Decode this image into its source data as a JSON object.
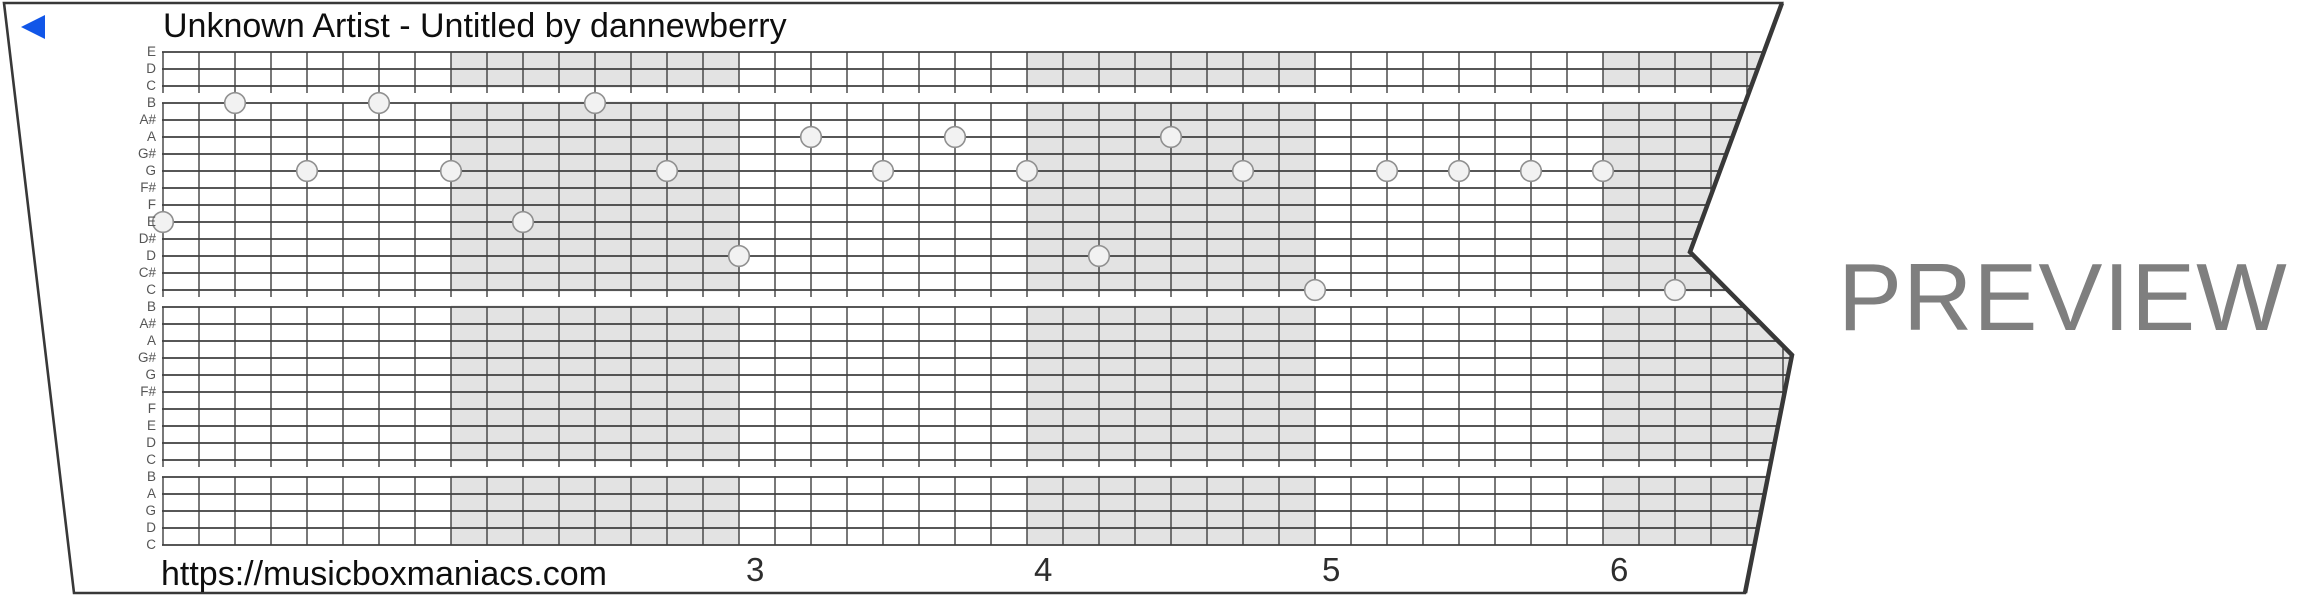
{
  "header": {
    "title": "Unknown Artist - Untitled by dannewberry"
  },
  "player": {
    "icon": "play-left-triangle"
  },
  "watermark": {
    "label": "PREVIEW"
  },
  "footer": {
    "url": "https://musicboxmaniacs.com"
  },
  "colors": {
    "accent_blue": "#1156e8",
    "measure_shade": "#e3e3e3",
    "grid_line": "#3f3f3f",
    "note_fill": "#f2f2f2",
    "note_stroke": "#909090",
    "sheet_border": "#383838",
    "watermark_gray": "#7f7f7f",
    "label_gray": "#555555",
    "text_black": "#0e0e0e"
  },
  "strip": {
    "row_labels": [
      "E",
      "D",
      "C",
      "B",
      "A#",
      "A",
      "G#",
      "G",
      "F#",
      "F",
      "E",
      "D#",
      "D",
      "C#",
      "C",
      "B",
      "A#",
      "A",
      "G#",
      "G",
      "F#",
      "F",
      "E",
      "D",
      "C",
      "B",
      "A",
      "G",
      "D",
      "C"
    ],
    "octave_gap_after_rows": [
      2,
      14,
      24
    ],
    "cols_per_measure": 8,
    "shaded_measure_start_cols": [
      8,
      24,
      40
    ],
    "measure_numbers": [
      {
        "label": "3",
        "col": 16
      },
      {
        "label": "4",
        "col": 24
      },
      {
        "label": "5",
        "col": 32
      },
      {
        "label": "6",
        "col": 40
      }
    ],
    "notes": [
      {
        "col": 0,
        "row": 10,
        "pitch": "E"
      },
      {
        "col": 2,
        "row": 3,
        "pitch": "B"
      },
      {
        "col": 4,
        "row": 7,
        "pitch": "G"
      },
      {
        "col": 6,
        "row": 3,
        "pitch": "B"
      },
      {
        "col": 8,
        "row": 7,
        "pitch": "G"
      },
      {
        "col": 10,
        "row": 10,
        "pitch": "E"
      },
      {
        "col": 12,
        "row": 3,
        "pitch": "B"
      },
      {
        "col": 14,
        "row": 7,
        "pitch": "G"
      },
      {
        "col": 16,
        "row": 12,
        "pitch": "D"
      },
      {
        "col": 18,
        "row": 5,
        "pitch": "A"
      },
      {
        "col": 20,
        "row": 7,
        "pitch": "G"
      },
      {
        "col": 22,
        "row": 5,
        "pitch": "A"
      },
      {
        "col": 24,
        "row": 7,
        "pitch": "G"
      },
      {
        "col": 26,
        "row": 12,
        "pitch": "D"
      },
      {
        "col": 28,
        "row": 5,
        "pitch": "A"
      },
      {
        "col": 30,
        "row": 7,
        "pitch": "G"
      },
      {
        "col": 32,
        "row": 14,
        "pitch": "C"
      },
      {
        "col": 34,
        "row": 7,
        "pitch": "G"
      },
      {
        "col": 36,
        "row": 7,
        "pitch": "G"
      },
      {
        "col": 38,
        "row": 7,
        "pitch": "G"
      },
      {
        "col": 40,
        "row": 7,
        "pitch": "G"
      },
      {
        "col": 42,
        "row": 14,
        "pitch": "C"
      }
    ]
  }
}
